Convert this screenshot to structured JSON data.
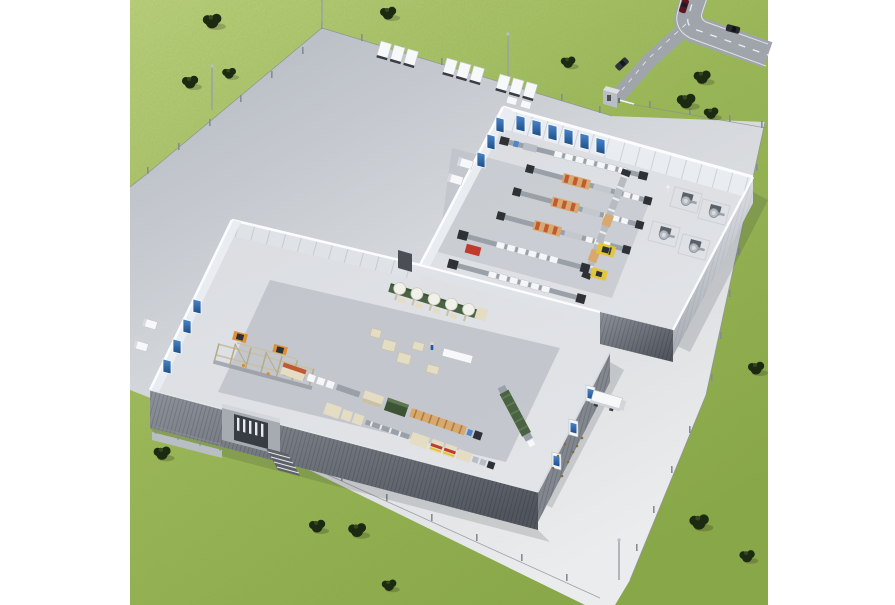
{
  "scene": {
    "label": "Isometric aerial 3D rendering of a factory campus with two cut-away production halls",
    "ground": {
      "label": "grass field with scattered trees",
      "trees": 15
    },
    "road": {
      "label": "public access road",
      "cars": 3,
      "gatehouse": 1,
      "barrier": 1
    },
    "yard": {
      "label": "fenced paved factory yard",
      "light_poles": 4,
      "fence": "perimeter posts"
    },
    "parked_trailers": {
      "groups": 3,
      "trailers_per_group": 3
    },
    "upper_hall": {
      "label": "production hall (roof removed)",
      "dock_doors_top_wall": 6,
      "dock_doors_west_wall": 3,
      "vans_at_west_docks": 2,
      "plate_conveyor_lines": 3,
      "tray_lines_with_product": 3,
      "transfer_conveyor": 1,
      "rotary_machine_cells": 4,
      "workers": 1,
      "forklift": 1,
      "floor_markings": [
        "red",
        "yellow",
        "yellow"
      ]
    },
    "lower_hall": {
      "label": "packaging hall (roof removed)",
      "dock_doors_west_wall": 4,
      "vans_at_west_docks": 2,
      "dock_doors_east_wall": 3,
      "docked_truck_east": 1,
      "mixing_tower_scaffold": 1,
      "tank_line_bowls": 5,
      "packaging_lines": 2,
      "green_processing_machine": 1,
      "workers": 1,
      "entrance_with_stairs": 1,
      "floor_markings": [
        "orange",
        "orange"
      ]
    }
  },
  "palette": {
    "grass1": "#bed47e",
    "grass2": "#9cba57",
    "grass3": "#88a945",
    "tree": "#1c2a12",
    "treeHi": "#33491d",
    "road": "#a0a5ac",
    "roadLine": "#f5f6f7",
    "pave1": "#b5bac2",
    "pave2": "#d4d7db",
    "pave3": "#ebeced",
    "wallTop": "#fbfcfd",
    "wallFace": "#e9ecf0",
    "wallFace2": "#dfe2e7",
    "wallDark1": "#8d929a",
    "wallDark2": "#51565e",
    "wallEast1": "#d9dce1",
    "wallEast2": "#a9aeb6",
    "floor1": "#d8dbdf",
    "floor2": "#e2e4e8",
    "zoneDark": "#b9bdc4",
    "dockBlue1": "#4b86cc",
    "dockBlue2": "#1d4e86",
    "white": "#f6f8f9",
    "metal": "#9aa0a8",
    "metalDark": "#5a6068",
    "beige": "#e4dcc3",
    "beigeDark": "#c9c1a6",
    "tan": "#d8a96e",
    "trayRed": "#bf5a33",
    "lineGreen": "#4a6342",
    "lineGreenDark": "#3c5336",
    "tank": "#f1f1ea",
    "red": "#c03a2e",
    "orange": "#df8a28",
    "yellow": "#e5c530",
    "dark": "#2e3237",
    "personBlue": "#2456a8",
    "personWhite": "#eef0f2",
    "wheel": "#3a3e44",
    "shadow": "#2e3338",
    "carRed": "#5a1622",
    "carBlack": "#26292e",
    "carGray": "#30343a"
  }
}
